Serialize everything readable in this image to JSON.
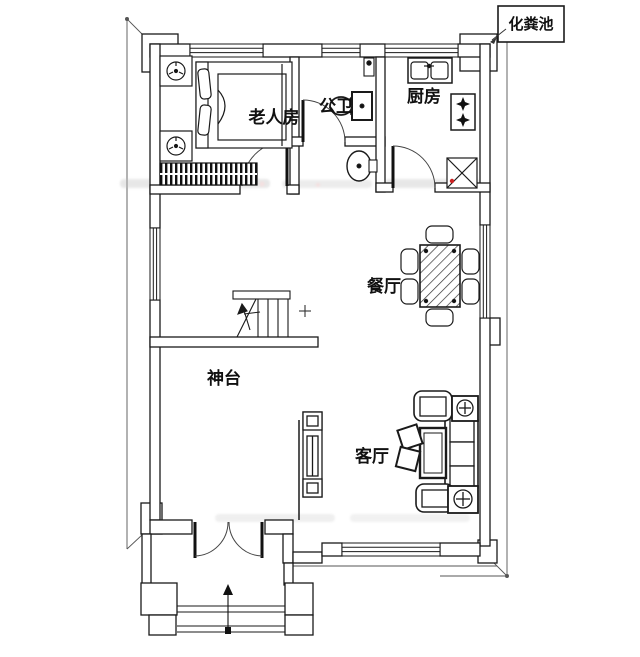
{
  "rooms": {
    "elderly_room": {
      "label": "老人房"
    },
    "bathroom": {
      "label": "公卫"
    },
    "kitchen": {
      "label": "厨房"
    },
    "dining": {
      "label": "餐厅"
    },
    "altar_hall": {
      "label": "神台"
    },
    "living": {
      "label": "客厅"
    }
  },
  "annotations": {
    "septic_tank": {
      "label": "化粪池"
    }
  },
  "colors": {
    "line": "#1a1a1a",
    "boundary": "#555555",
    "accent_red": "#cc2222",
    "watermark": "#bdbdbd",
    "background": "#ffffff"
  }
}
